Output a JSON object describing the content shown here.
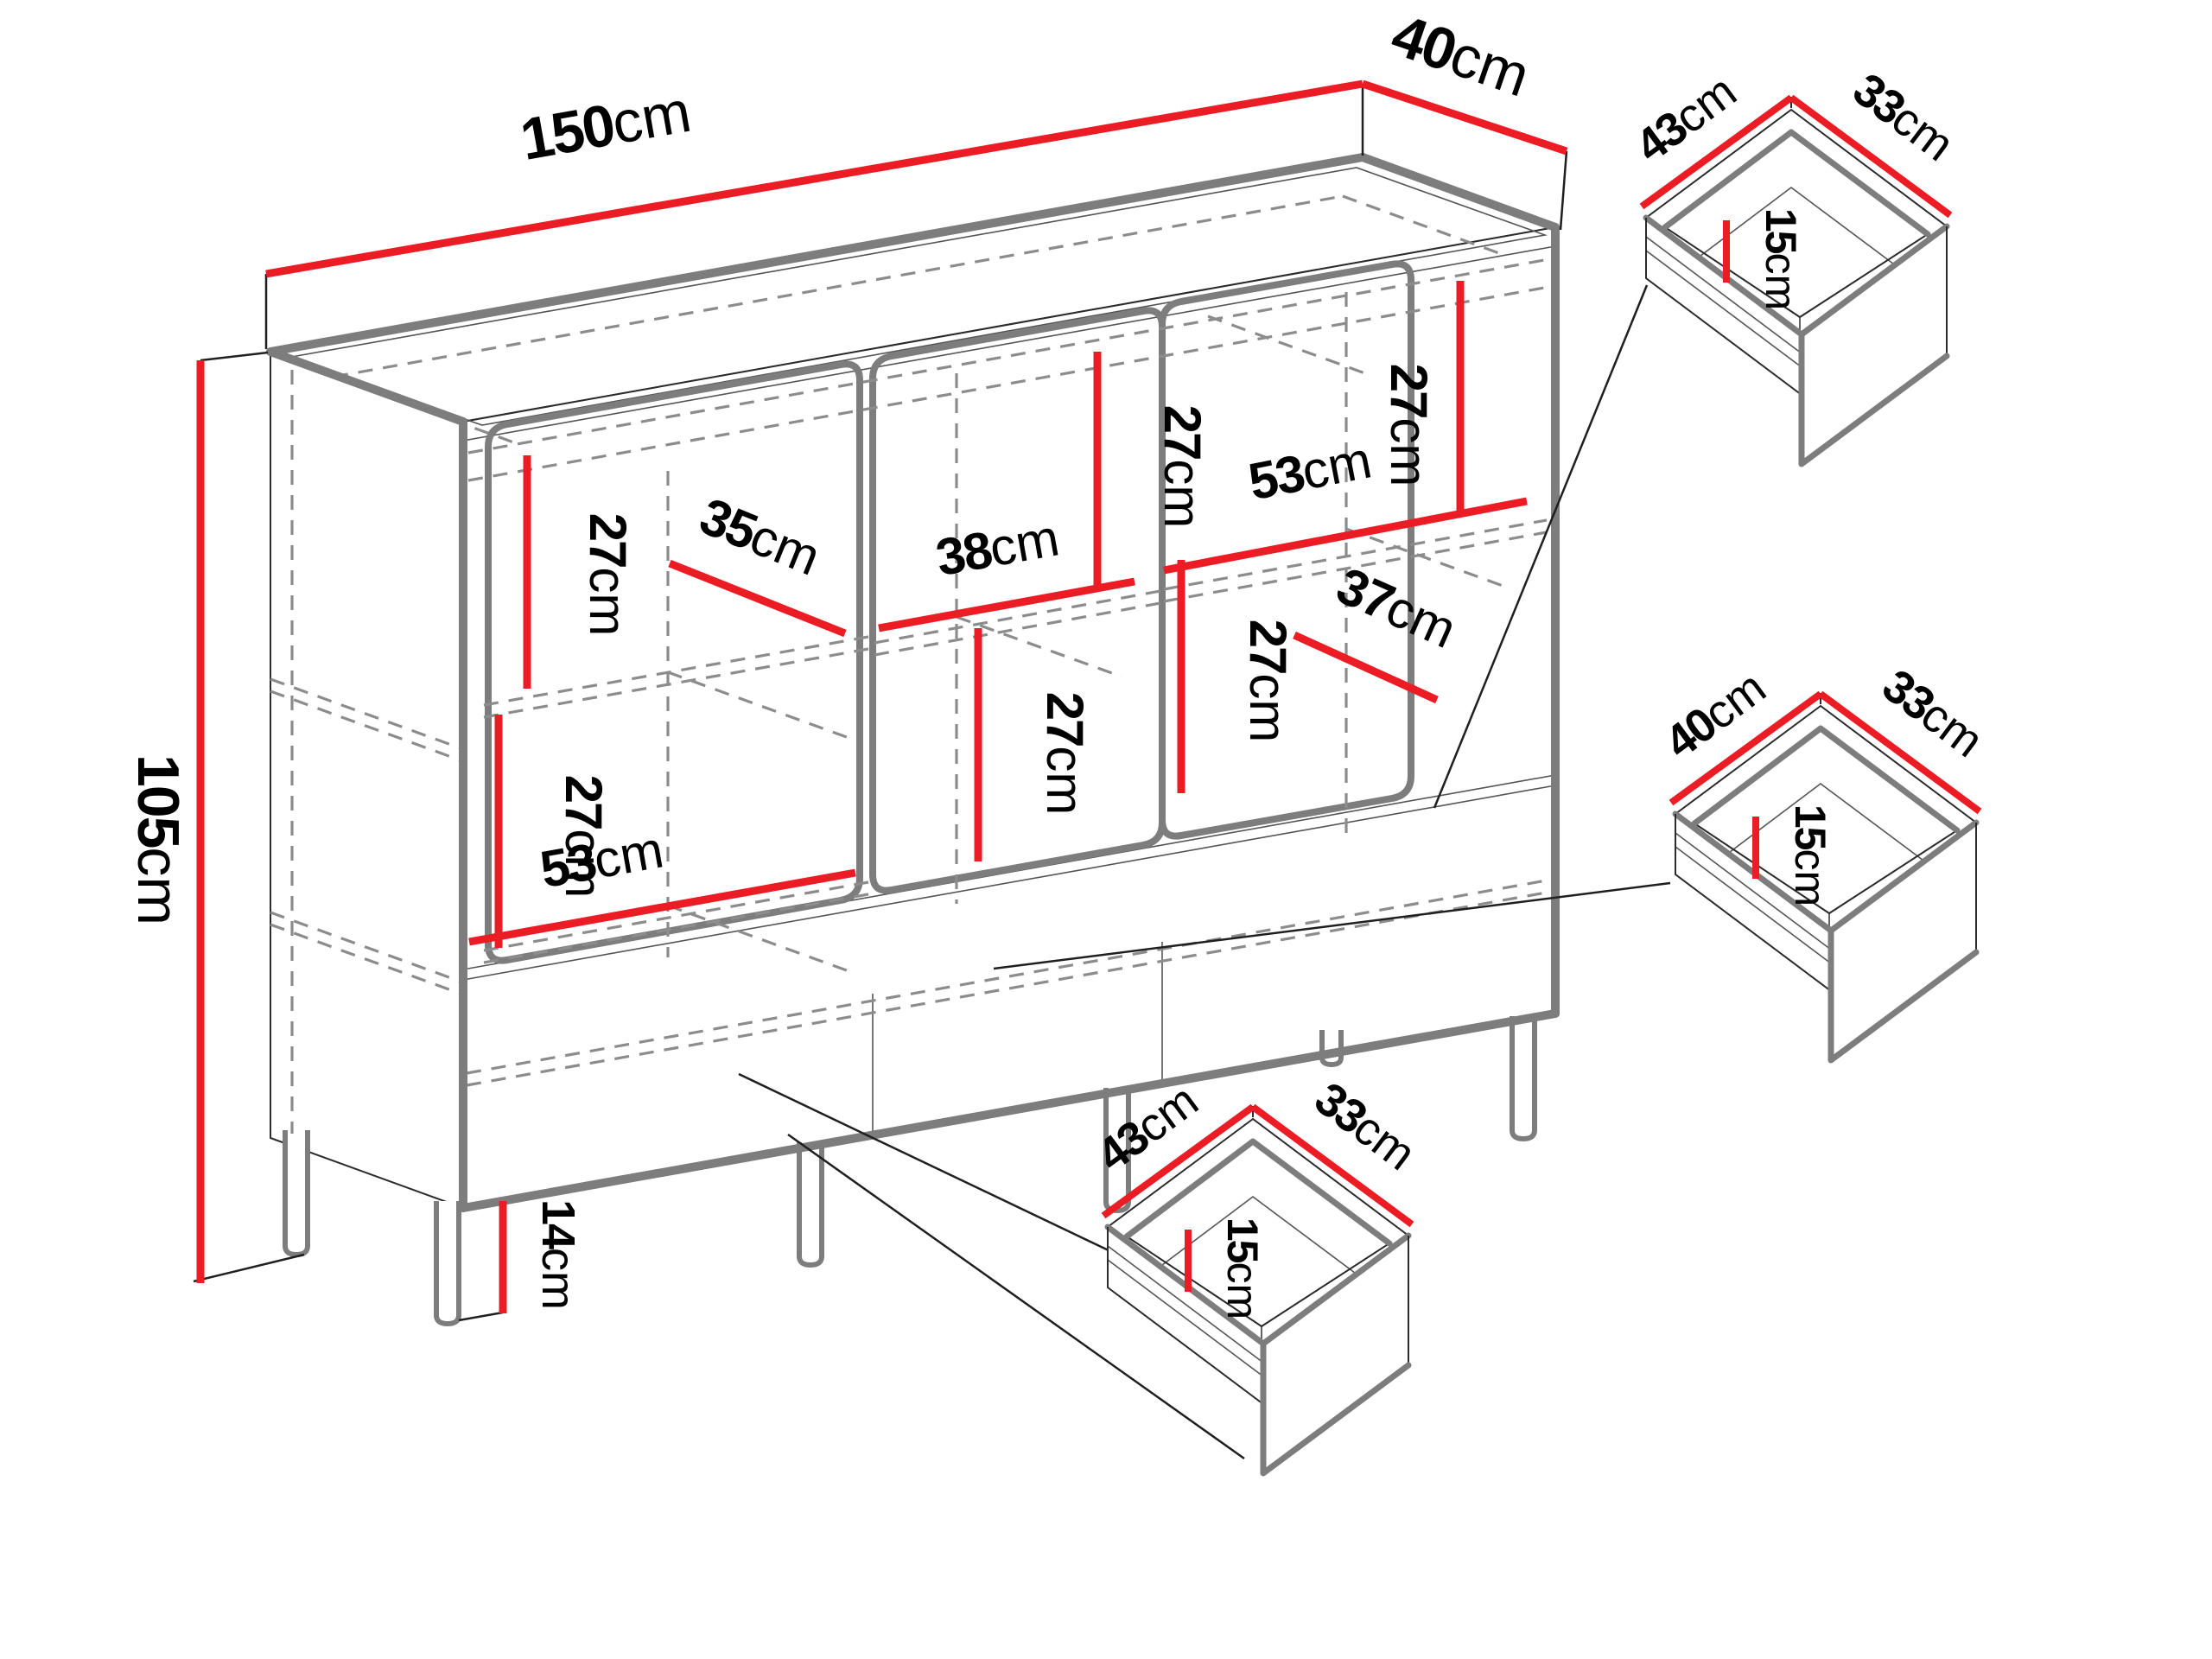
{
  "diagram": {
    "type": "furniture-dimension-diagram",
    "unit": "cm",
    "colors": {
      "dimension_line": "#ec1c24",
      "outline_gray": "#7d7d7d",
      "outline_black": "#2b2b2b",
      "dashed_hidden": "#8c8c8c",
      "background": "#ffffff"
    },
    "cabinet": {
      "width": {
        "value": "150",
        "unit": "cm"
      },
      "depth": {
        "value": "40",
        "unit": "cm"
      },
      "height": {
        "value": "105",
        "unit": "cm"
      },
      "leg_height": {
        "value": "14",
        "unit": "cm"
      },
      "interior": {
        "left_upper_height": {
          "value": "27",
          "unit": "cm"
        },
        "left_shelf_depth": {
          "value": "35",
          "unit": "cm"
        },
        "left_lower_height": {
          "value": "27",
          "unit": "cm"
        },
        "left_lower_width": {
          "value": "53",
          "unit": "cm"
        },
        "middle_upper_height": {
          "value": "27",
          "unit": "cm"
        },
        "middle_shelf_width": {
          "value": "38",
          "unit": "cm"
        },
        "middle_lower_height": {
          "value": "27",
          "unit": "cm"
        },
        "right_upper_height": {
          "value": "27",
          "unit": "cm"
        },
        "right_shelf_width": {
          "value": "53",
          "unit": "cm"
        },
        "right_lower_height": {
          "value": "27",
          "unit": "cm"
        },
        "right_shelf_depth": {
          "value": "37",
          "unit": "cm"
        }
      }
    },
    "drawers": [
      {
        "id": "drawer-top-right",
        "width": {
          "value": "43",
          "unit": "cm"
        },
        "depth": {
          "value": "33",
          "unit": "cm"
        },
        "height": {
          "value": "15",
          "unit": "cm"
        }
      },
      {
        "id": "drawer-middle-right",
        "width": {
          "value": "40",
          "unit": "cm"
        },
        "depth": {
          "value": "33",
          "unit": "cm"
        },
        "height": {
          "value": "15",
          "unit": "cm"
        }
      },
      {
        "id": "drawer-bottom-center",
        "width": {
          "value": "43",
          "unit": "cm"
        },
        "depth": {
          "value": "33",
          "unit": "cm"
        },
        "height": {
          "value": "15",
          "unit": "cm"
        }
      }
    ]
  }
}
